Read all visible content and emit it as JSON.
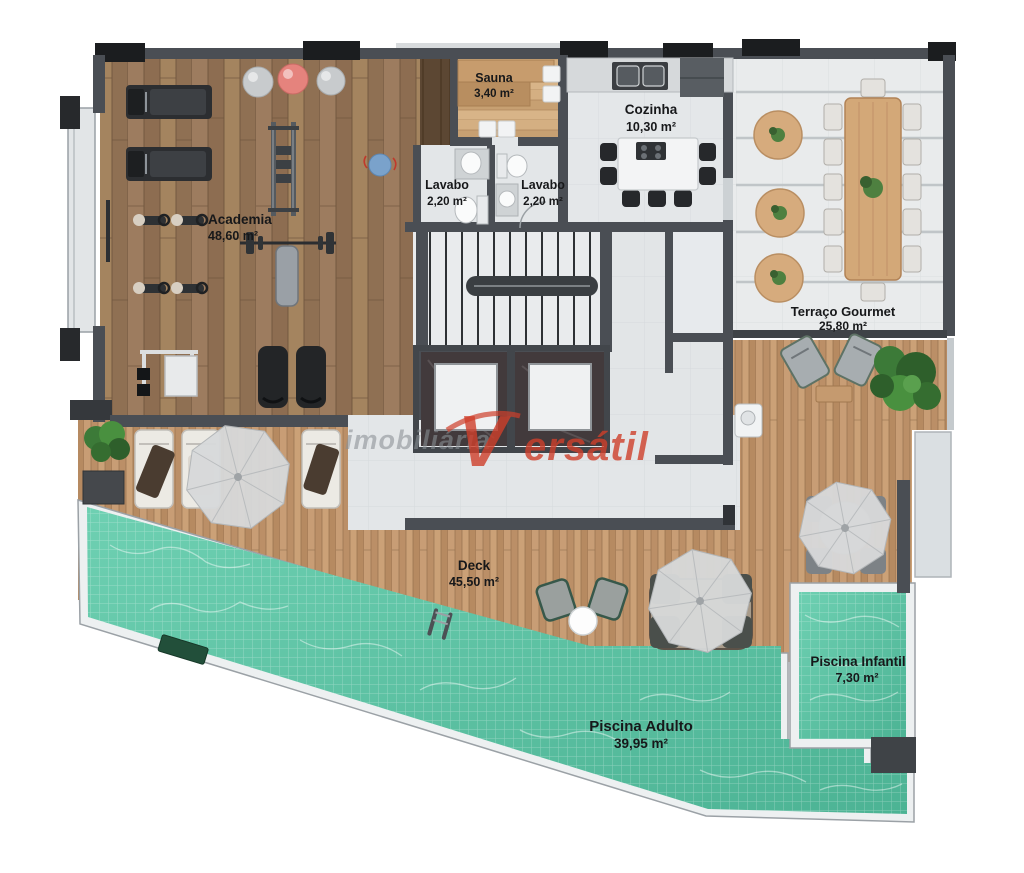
{
  "title": "Planta baixa - área de lazer",
  "watermark": {
    "brand_prefix": "imobiliária",
    "brand_v": "V",
    "brand_rest": "ersátil",
    "color_red": "#cf3f2b",
    "color_gray": "#8a9095"
  },
  "rooms": {
    "academia": {
      "label": "Academia",
      "area": "48,60 m²"
    },
    "sauna": {
      "label": "Sauna",
      "area": "3,40 m²"
    },
    "lavabo1": {
      "label": "Lavabo",
      "area": "2,20 m²"
    },
    "lavabo2": {
      "label": "Lavabo",
      "area": "2,20 m²"
    },
    "cozinha": {
      "label": "Cozinha",
      "area": "10,30 m²"
    },
    "terraco": {
      "label": "Terraço Gourmet",
      "area": "25,80 m²"
    },
    "deck": {
      "label": "Deck",
      "area": "45,50 m²"
    },
    "piscina_adulto": {
      "label": "Piscina Adulto",
      "area": "39,95 m²"
    },
    "piscina_infantil": {
      "label": "Piscina Infantil",
      "area": "7,30 m²"
    }
  },
  "colors": {
    "pool_water": "#5cc3a6",
    "pool_coping": "#edf0f1",
    "gym_wood": "#97765a",
    "deck_wood": "#c2966e",
    "wall": "#4a4e54",
    "column_black": "#1b1d1f",
    "interior_floor": "#e4e7e9",
    "terrace_floor": "#e9ebec"
  }
}
